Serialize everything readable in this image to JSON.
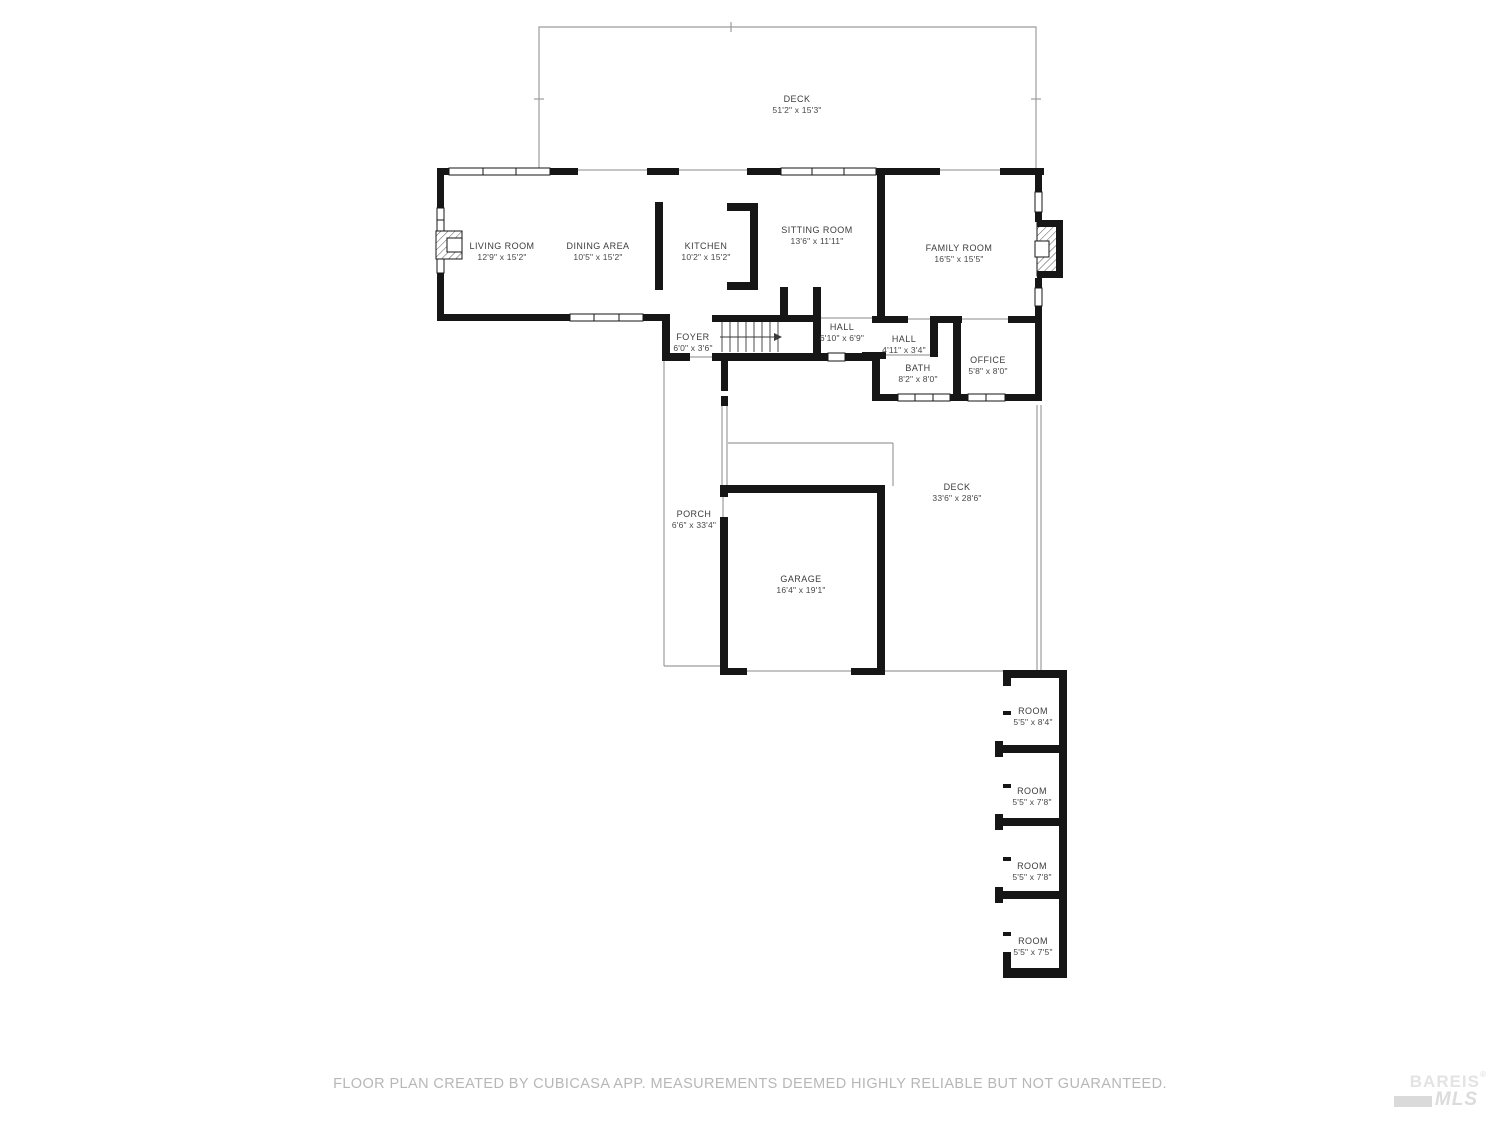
{
  "page": {
    "background": "#ffffff"
  },
  "colors": {
    "wall": "#161616",
    "outdoor_line": "#9c9c9c",
    "room_label_text": "#3c3c3c",
    "footer_text": "#b7b7b7",
    "logo_text": "#e3e3e3"
  },
  "rooms": [
    {
      "id": "deck-top",
      "label": "DECK",
      "dims": "51'2\" x 15'3\""
    },
    {
      "id": "living-room",
      "label": "LIVING ROOM",
      "dims": "12'9\" x 15'2\""
    },
    {
      "id": "dining-area",
      "label": "DINING AREA",
      "dims": "10'5\" x 15'2\""
    },
    {
      "id": "kitchen",
      "label": "KITCHEN",
      "dims": "10'2\" x 15'2\""
    },
    {
      "id": "sitting-room",
      "label": "SITTING ROOM",
      "dims": "13'6\" x 11'11\""
    },
    {
      "id": "family-room",
      "label": "FAMILY ROOM",
      "dims": "16'5\" x 15'5\""
    },
    {
      "id": "foyer",
      "label": "FOYER",
      "dims": "6'0\" x 3'6\""
    },
    {
      "id": "hall-upper",
      "label": "HALL",
      "dims": "6'10\" x 6'9\""
    },
    {
      "id": "hall-lower",
      "label": "HALL",
      "dims": "4'11\" x 3'4\""
    },
    {
      "id": "bath",
      "label": "BATH",
      "dims": "8'2\" x 8'0\""
    },
    {
      "id": "office",
      "label": "OFFICE",
      "dims": "5'8\" x 8'0\""
    },
    {
      "id": "porch",
      "label": "PORCH",
      "dims": "6'6\" x 33'4\""
    },
    {
      "id": "deck-main",
      "label": "DECK",
      "dims": "33'6\" x 28'6\""
    },
    {
      "id": "garage",
      "label": "GARAGE",
      "dims": "16'4\" x 19'1\""
    },
    {
      "id": "room-1",
      "label": "ROOM",
      "dims": "5'5\" x 8'4\""
    },
    {
      "id": "room-2",
      "label": "ROOM",
      "dims": "5'5\" x 7'8\""
    },
    {
      "id": "room-3",
      "label": "ROOM",
      "dims": "5'5\" x 7'8\""
    },
    {
      "id": "room-4",
      "label": "ROOM",
      "dims": "5'5\" x 7'5\""
    }
  ],
  "footer": {
    "disclaimer": "FLOOR PLAN CREATED BY CUBICASA APP. MEASUREMENTS DEEMED HIGHLY RELIABLE BUT NOT GUARANTEED."
  },
  "logo": {
    "line1": "BAREIS",
    "registered": "®",
    "line2": "MLS"
  }
}
